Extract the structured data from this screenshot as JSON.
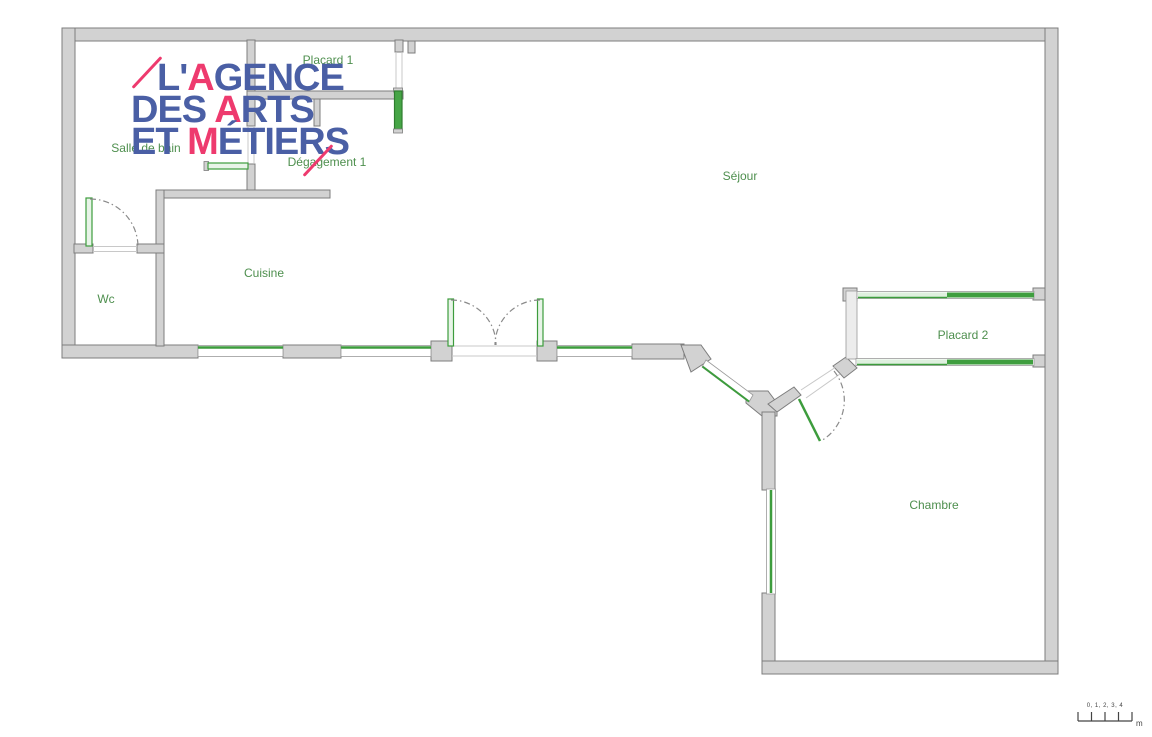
{
  "logo": {
    "line1_pre": "L'",
    "line1_accent": "A",
    "line1_post": "GENCE",
    "line2_pre": "DES ",
    "line2_accent": "A",
    "line2_post": "RTS",
    "line3_pre": "ET ",
    "line3_accent": "M",
    "line3_post": "ÉTIERS",
    "color_blue": "#4a5fa5",
    "color_pink": "#ee3a6e"
  },
  "rooms": [
    {
      "label": "Placard 1"
    },
    {
      "label": "Salle de bain"
    },
    {
      "label": "Dégagement 1"
    },
    {
      "label": "Séjour"
    },
    {
      "label": "Wc"
    },
    {
      "label": "Cuisine"
    },
    {
      "label": "Placard 2"
    },
    {
      "label": "Chambre"
    }
  ],
  "scale_bar": {
    "text": "0, 1, 2, 3, 4",
    "unit": "m"
  },
  "colors": {
    "wall_fill": "#d2d2d2",
    "wall_stroke": "#7d7d7d",
    "door_green": "#3d9c3d",
    "door_green_dark": "#2e7d2e",
    "door_green_light": "#e8f4e8",
    "closet_green_light": "#dff0df",
    "label_green": "#4e8f4e"
  }
}
